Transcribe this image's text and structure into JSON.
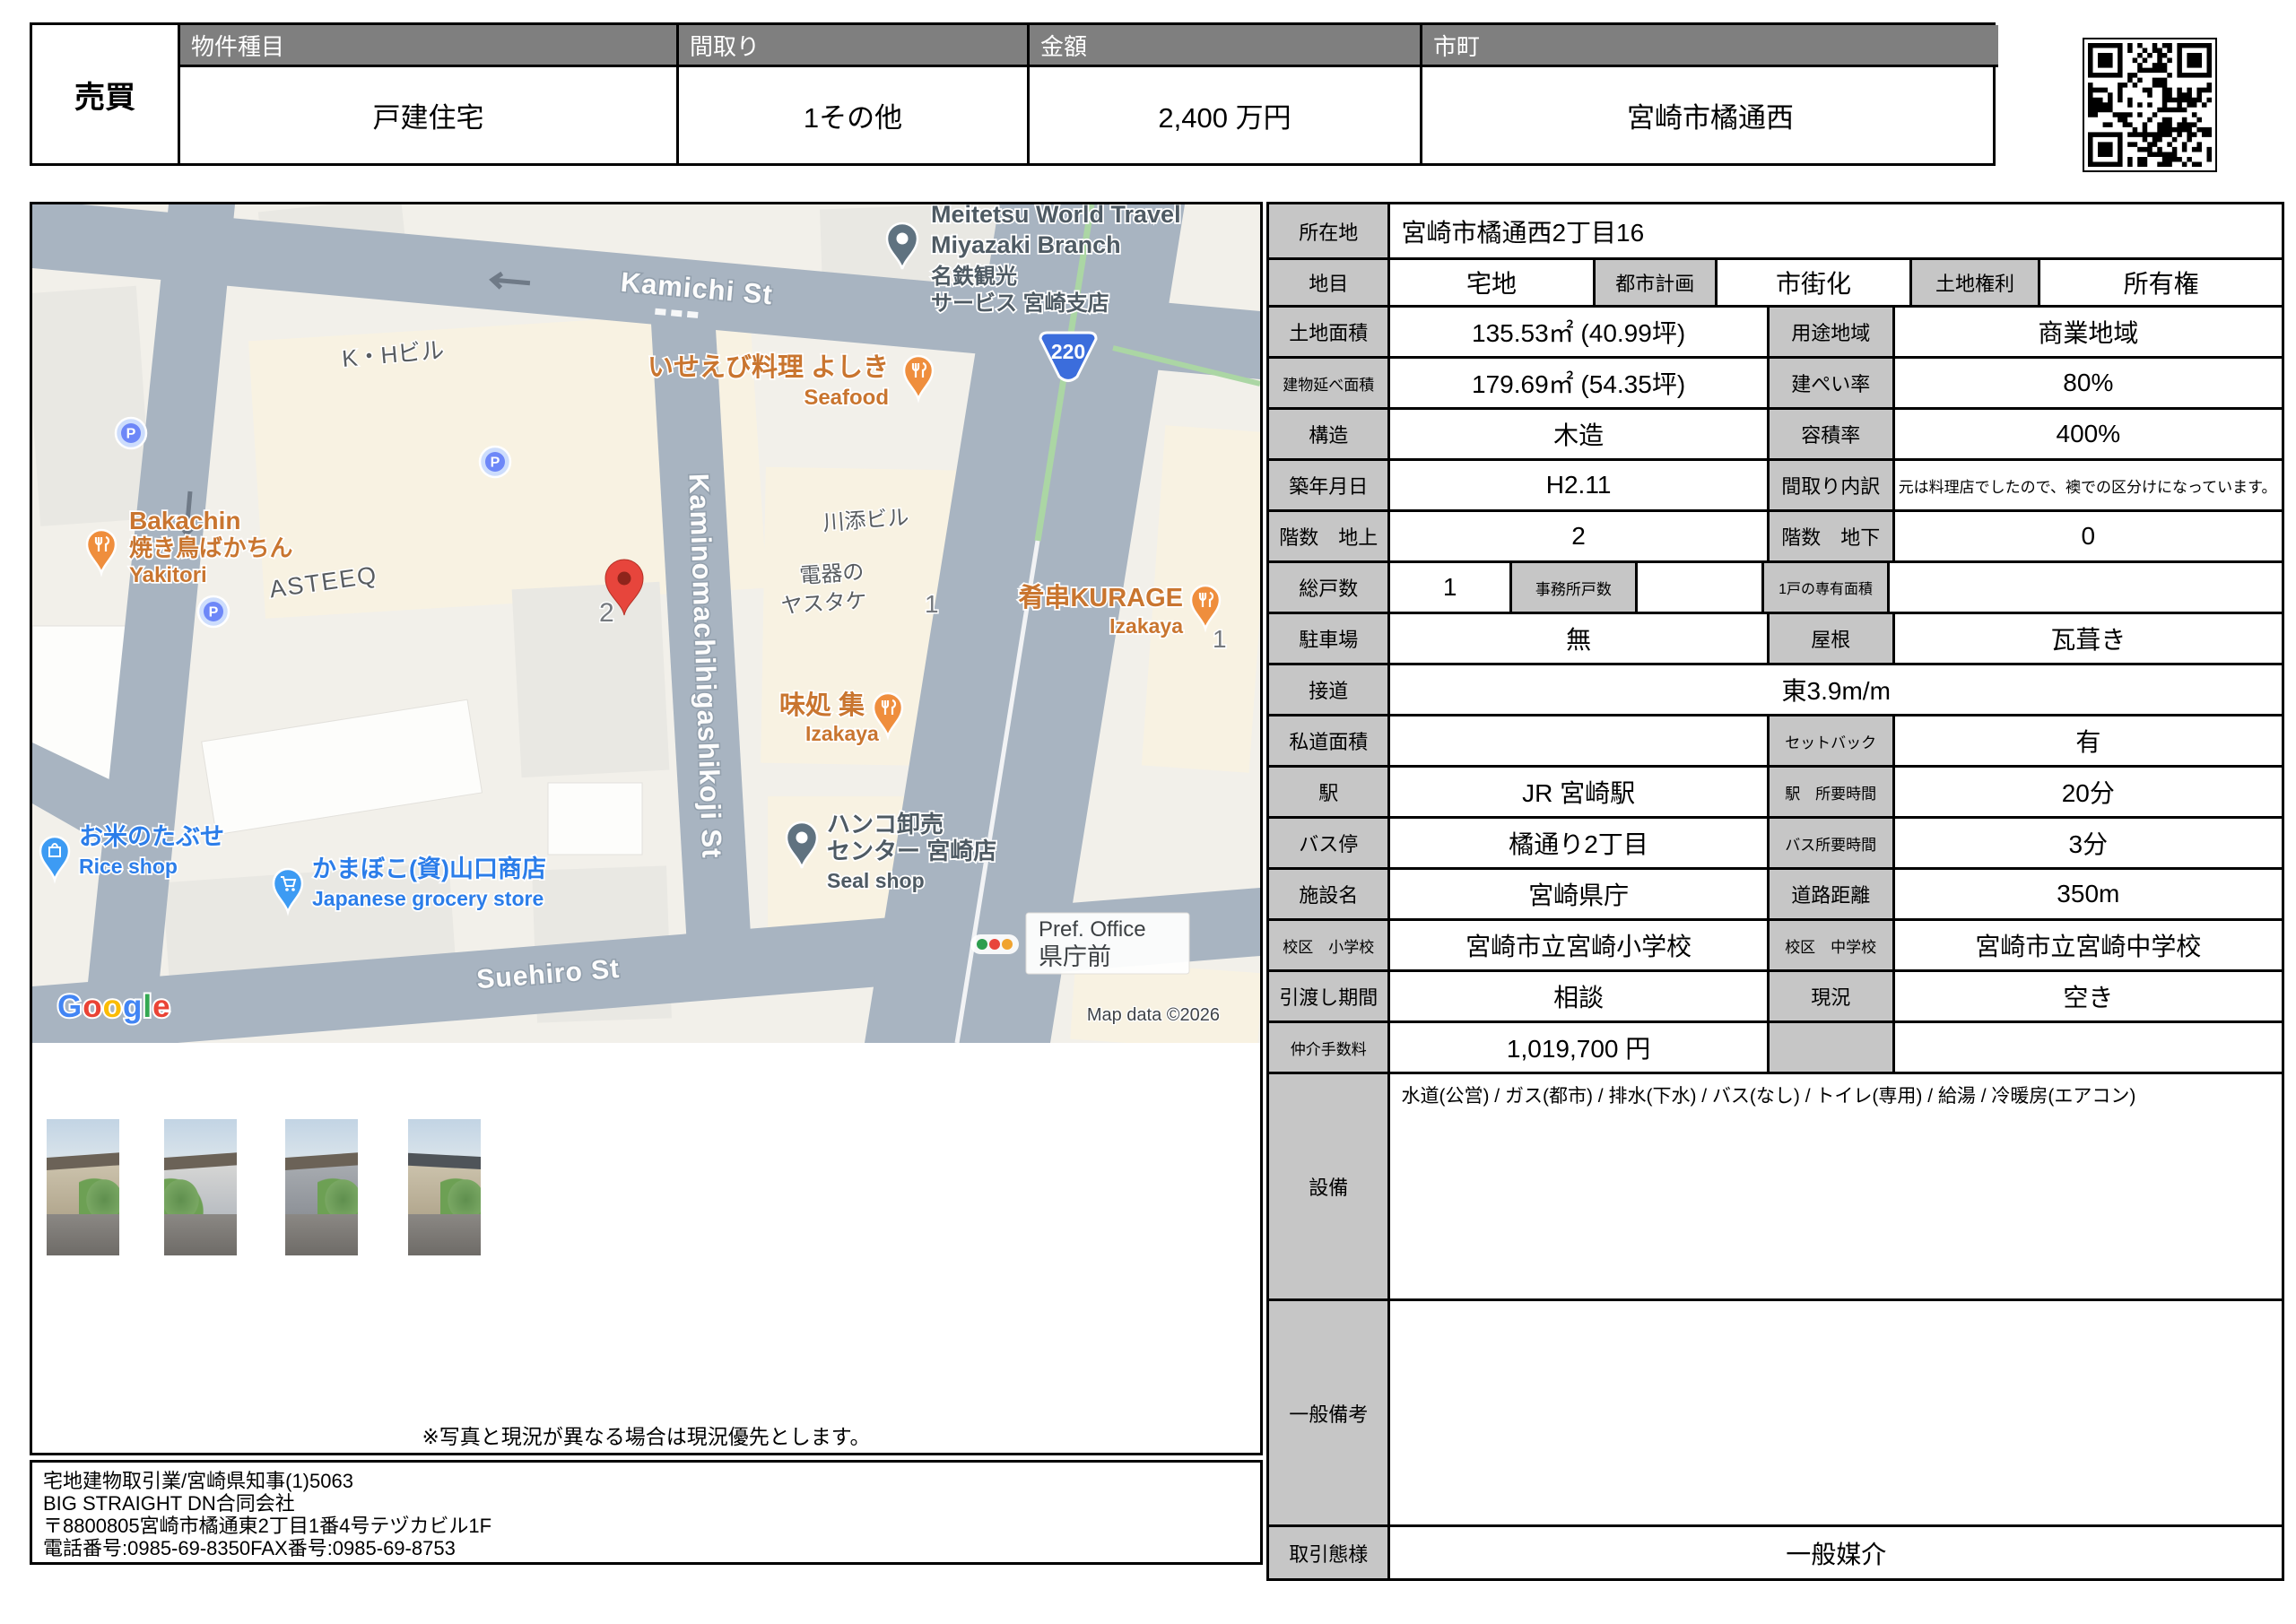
{
  "colors": {
    "header_gray": "#7f7f7f",
    "label_gray": "#c6c6c6",
    "map_bg": "#f2f0ea",
    "road": "#a8b4c1",
    "map_cream": "#f8f2e2",
    "marker_red": "#e7453c",
    "poi_orange": "#ef8e3d",
    "poi_orange_text": "#c9752f",
    "poi_blue": "#3d9bf3",
    "poi_blue_text": "#2b7de9",
    "poi_gray": "#5f7280",
    "route_blue": "#3b6ddc"
  },
  "header": {
    "deal_type": "売買",
    "col1_label": "物件種目",
    "col1_value": "戸建住宅",
    "col2_label": "間取り",
    "col2_value": "1その他",
    "col3_label": "金額",
    "col3_value": "2,400 万円",
    "col4_label": "市町",
    "col4_value": "宮崎市橘通西"
  },
  "map": {
    "streets": {
      "kamichi": "Kamichi St",
      "suehiro": "Suehiro St",
      "kaminomachi": "Kaminomachihigashikoji St"
    },
    "route_badge": "220",
    "parking": "P",
    "block_2": "2",
    "block_1a": "1",
    "block_1b": "1",
    "labels": {
      "meitetsu1": "Meitetsu World Travel",
      "meitetsu2": "Miyazaki Branch",
      "meitetsu3": "名鉄観光",
      "meitetsu4": "サービス 宮崎支店",
      "iseebi": "いせえび料理 よしき",
      "iseebi_sub": "Seafood",
      "kh": "K・Hビル",
      "bakachin1": "Bakachin",
      "bakachin2": "焼き鳥ばかちん",
      "bakachin3": "Yakitori",
      "asteeq": "ASTEEQ",
      "kawazoe": "川添ビル",
      "yasutake1": "電器の",
      "yasutake2": "ヤスタケ",
      "kurage": "肴串KURAGE",
      "kurage_sub": "Izakaya",
      "ajidokoro": "味処 集",
      "ajidokoro_sub": "Izakaya",
      "okome": "お米のたぶせ",
      "okome_sub": "Rice shop",
      "kamaboko": "かまぼこ(資)山口商店",
      "kamaboko_sub": "Japanese grocery store",
      "hanko1": "ハンコ卸売",
      "hanko2": "センター 宮崎店",
      "hanko_sub": "Seal shop",
      "pref1": "Pref. Office",
      "pref2": "県庁前"
    },
    "google_letters": [
      "G",
      "o",
      "o",
      "g",
      "l",
      "e"
    ],
    "copyright": "Map data ©2026"
  },
  "details": {
    "location_label": "所在地",
    "location": "宮崎市橘通西2丁目16",
    "land_category_label": "地目",
    "land_category": "宅地",
    "city_planning_label": "都市計画",
    "city_planning": "市街化",
    "land_rights_label": "土地権利",
    "land_rights": "所有権",
    "land_area_label": "土地面積",
    "land_area": "135.53㎡ (40.99坪)",
    "zoning_label": "用途地域",
    "zoning": "商業地域",
    "floor_area_label": "建物延べ面積",
    "floor_area": "179.69㎡ (54.35坪)",
    "bcr_label": "建ぺい率",
    "bcr": "80%",
    "structure_label": "構造",
    "structure": "木造",
    "far_label": "容積率",
    "far": "400%",
    "built_label": "築年月日",
    "built": "H2.11",
    "layout_detail_label": "間取り内訳",
    "layout_detail": "元は料理店でしたので、襖での区分けになっています。",
    "floors_above_label": "階数　地上",
    "floors_above": "2",
    "floors_below_label": "階数　地下",
    "floors_below": "0",
    "total_units_label": "総戸数",
    "total_units": "1",
    "office_units_label": "事務所戸数",
    "office_units": "",
    "unit_area_label": "1戸の専有面積",
    "unit_area": "",
    "parking_label": "駐車場",
    "parking": "無",
    "roof_label": "屋根",
    "roof": "瓦葺き",
    "road_contact_label": "接道",
    "road_contact": "東3.9m/m",
    "private_road_label": "私道面積",
    "private_road": "",
    "setback_label": "セットバック",
    "setback": "有",
    "station_label": "駅",
    "station": "JR 宮崎駅",
    "station_time_label": "駅　所要時間",
    "station_time": "20分",
    "bus_stop_label": "バス停",
    "bus_stop": "橘通り2丁目",
    "bus_time_label": "バス所要時間",
    "bus_time": "3分",
    "facility_label": "施設名",
    "facility": "宮崎県庁",
    "road_distance_label": "道路距離",
    "road_distance": "350m",
    "elementary_label": "校区　小学校",
    "elementary": "宮崎市立宮崎小学校",
    "junior_high_label": "校区　中学校",
    "junior_high": "宮崎市立宮崎中学校",
    "handover_label": "引渡し期間",
    "handover": "相談",
    "current_status_label": "現況",
    "current_status": "空き",
    "commission_label": "仲介手数料",
    "commission": "1,019,700 円",
    "equipment_label": "設備",
    "equipment": "水道(公営) / ガス(都市) / 排水(下水) / バス(なし) / トイレ(専用) / 給湯 / 冷暖房(エアコン)",
    "remarks_label": "一般備考",
    "remarks": "",
    "transaction_type_label": "取引態様",
    "transaction_type": "一般媒介"
  },
  "footer": {
    "note": "※写真と現況が異なる場合は現況優先とします。",
    "agency_lines": [
      "宅地建物取引業/宮崎県知事(1)5063",
      "BIG STRAIGHT DN合同会社",
      "〒8800805宮崎市橘通東2丁目1番4号テヅカビル1F",
      "電話番号:0985-69-8350FAX番号:0985-69-8753"
    ]
  }
}
